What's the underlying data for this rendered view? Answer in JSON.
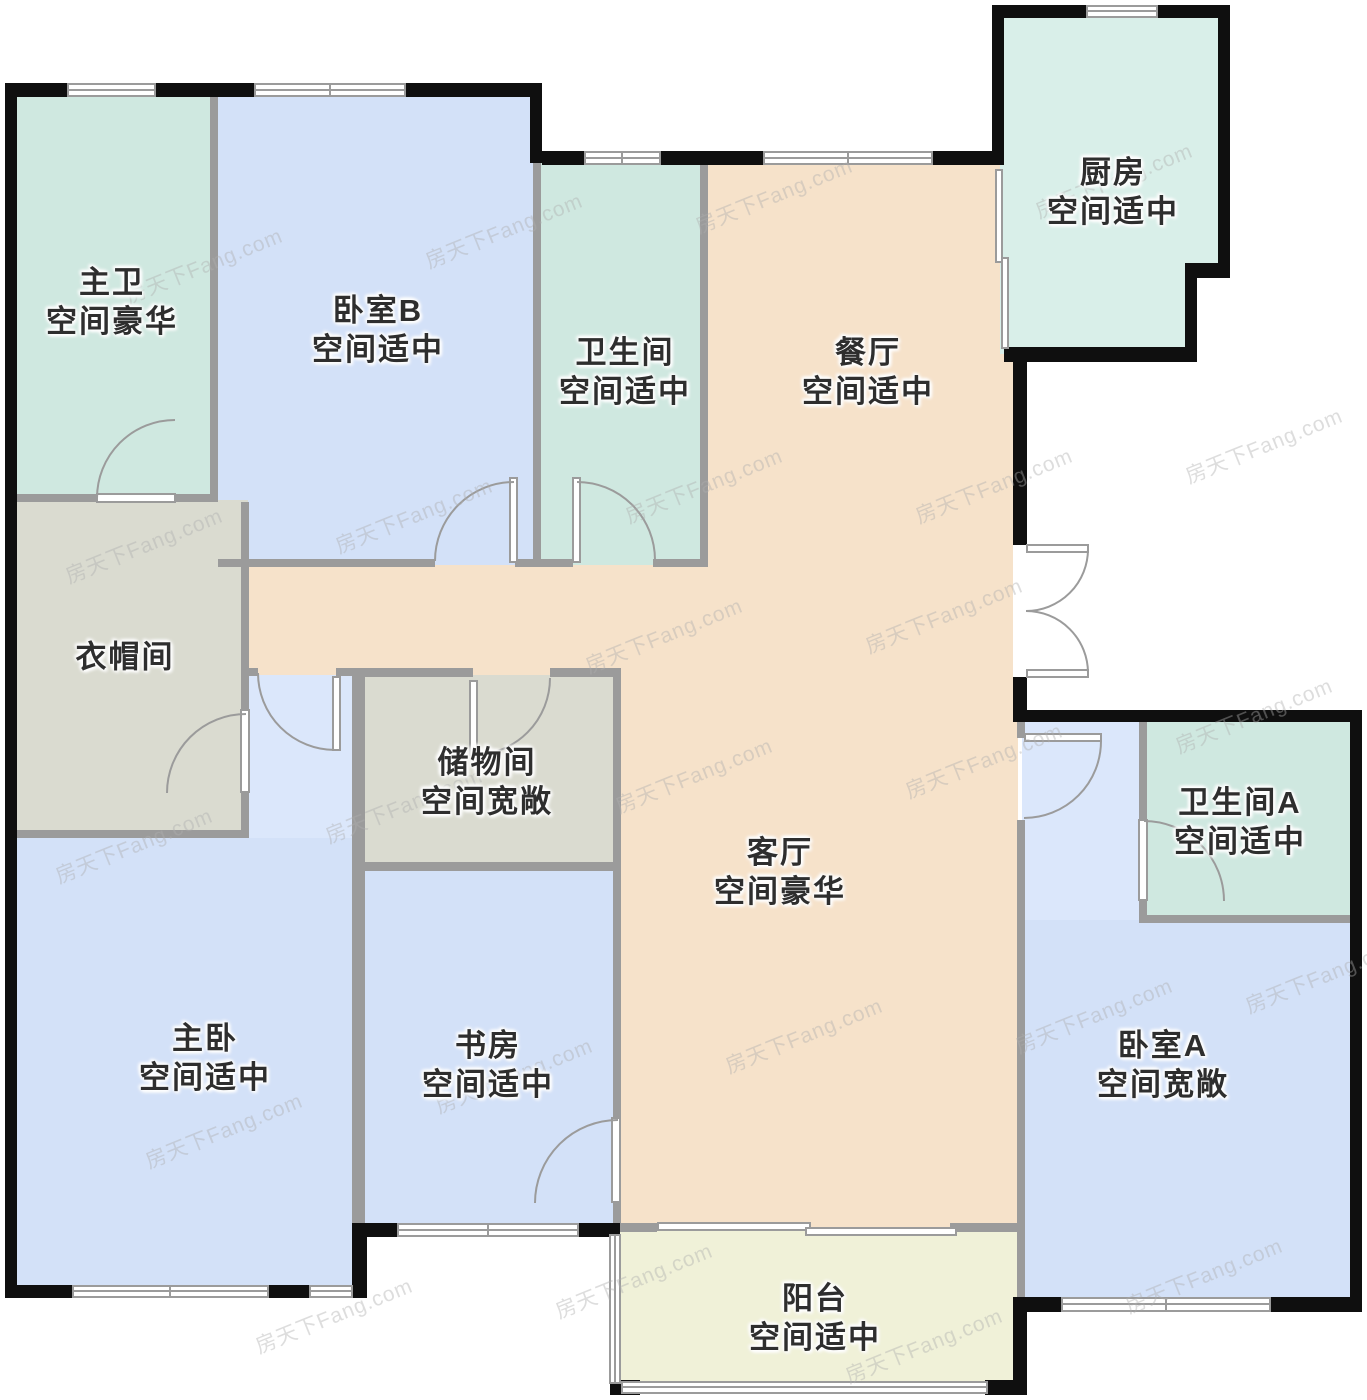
{
  "title": "户型图",
  "watermark": {
    "text": "房天下Fang.com",
    "color": "#bdbdbd"
  },
  "palette": {
    "exterior_wall": "#0f0f0f",
    "interior_wall": "#9b9b9b",
    "bath_teal": "#cfe8e0",
    "kitchen_mint": "#d9efe9",
    "bedroom_blue": "#d3e1f8",
    "nook_blue": "#dbe7fb",
    "living_peach": "#f6e2ca",
    "closet_gray": "#dadbd0",
    "balcony_cream": "#f0f1d8",
    "label_color": "#2e2e2e",
    "opening_white": "#ffffff"
  },
  "rooms": {
    "master_bath": {
      "name": "主卫",
      "size": "空间豪华"
    },
    "bedroom_b": {
      "name": "卧室B",
      "size": "空间适中"
    },
    "bath": {
      "name": "卫生间",
      "size": "空间适中"
    },
    "dining": {
      "name": "餐厅",
      "size": "空间适中"
    },
    "kitchen": {
      "name": "厨房",
      "size": "空间适中"
    },
    "cloak": {
      "name": "衣帽间",
      "size": ""
    },
    "storage": {
      "name": "储物间",
      "size": "空间宽敞"
    },
    "living": {
      "name": "客厅",
      "size": "空间豪华"
    },
    "bath_a": {
      "name": "卫生间A",
      "size": "空间适中"
    },
    "master_bed": {
      "name": "主卧",
      "size": "空间适中"
    },
    "study": {
      "name": "书房",
      "size": "空间适中"
    },
    "bedroom_a": {
      "name": "卧室A",
      "size": "空间宽敞"
    },
    "balcony": {
      "name": "阳台",
      "size": "空间适中"
    }
  }
}
